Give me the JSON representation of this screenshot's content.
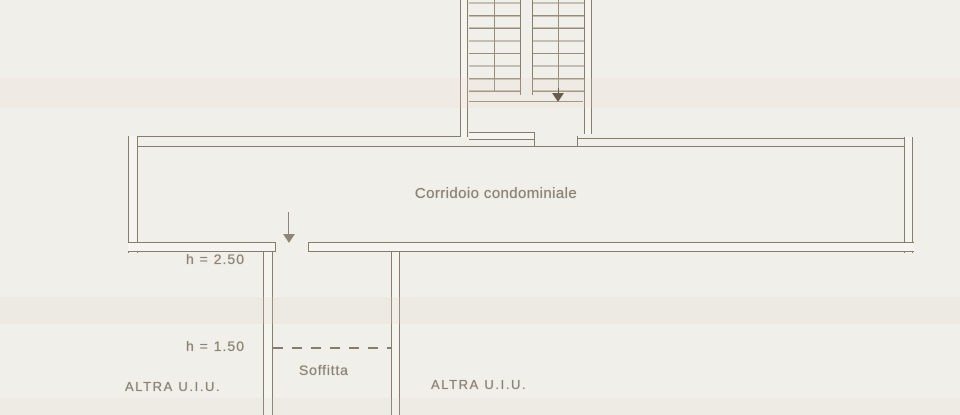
{
  "plan": {
    "corridor": {
      "label": "Corridoio condominiale",
      "entry_icon": "down-arrow"
    },
    "stairwell": {
      "direction_icon": "down-arrow"
    },
    "attic": {
      "label": "Soffitta",
      "height_upper": "h = 2.50",
      "height_lower": "h = 1.50"
    },
    "adjacent_units": {
      "left_label": "ALTRA U.I.U.",
      "right_label": "ALTRA U.I.U."
    }
  },
  "colors": {
    "paper": "#f1efe9",
    "line": "#867e6d",
    "tread": "#968e7d",
    "wall_fill": "#f6f4ee",
    "text": "#8a8376",
    "arrow_dark": "#4e4639",
    "arrow_light": "#8d8579"
  }
}
